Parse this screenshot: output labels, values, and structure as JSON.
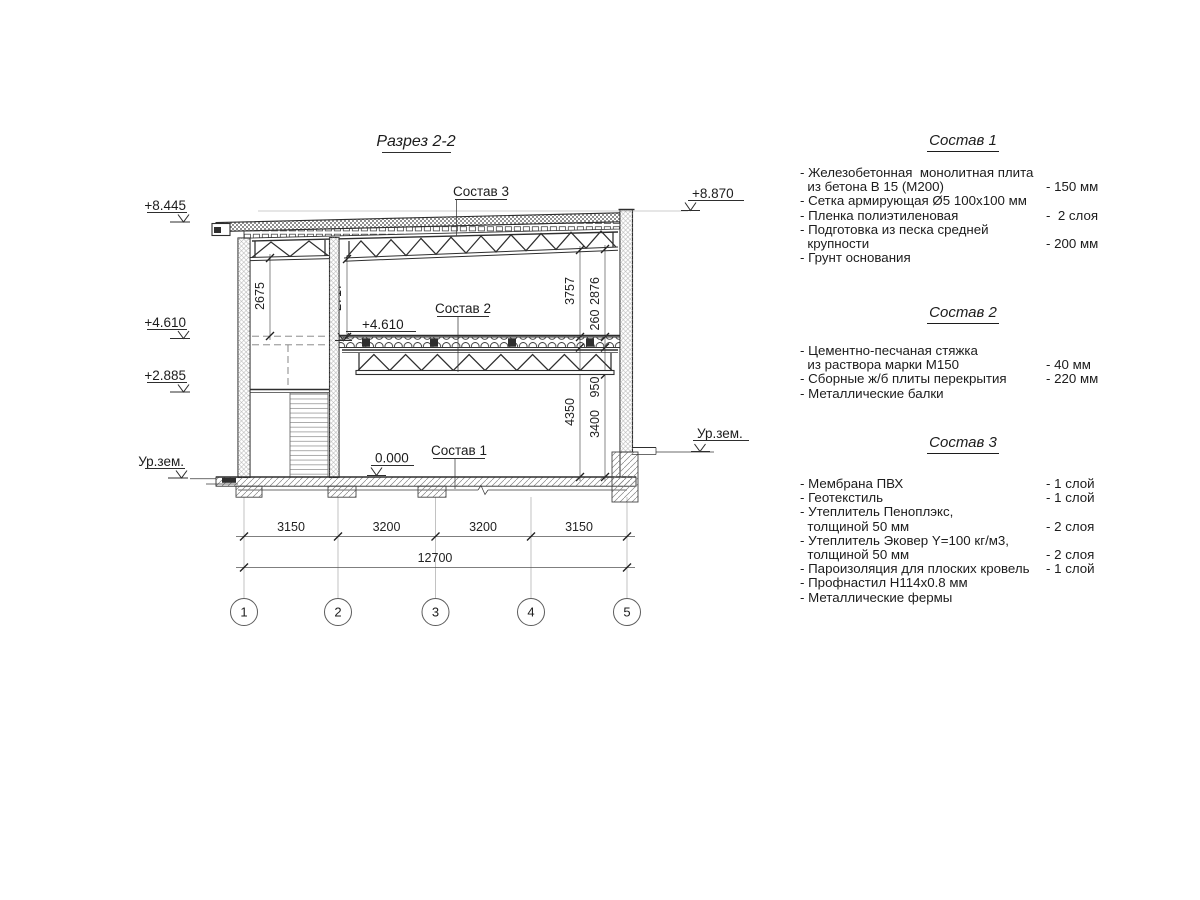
{
  "title": "Разрез 2-2",
  "drawing": {
    "elevations": {
      "roof_left": "+8.445",
      "roof_right": "+8.870",
      "mid_left": "+4.610",
      "mid_inner": "+4.610",
      "landing": "+2.885",
      "ground_left": "Ур.зем.",
      "ground_right": "Ур.зем.",
      "zero": "0.000"
    },
    "callouts": {
      "c1": "Состав 1",
      "c2": "Состав 2",
      "c3": "Состав 3"
    },
    "vdims": {
      "left_bay": "2675",
      "hall": "2717",
      "upper_right": "3757",
      "upper_clear": "2876",
      "slab": "260",
      "truss_depth": "950",
      "lower_clear": "3400",
      "lower_total": "4350"
    },
    "hdims": {
      "spans": [
        "3150",
        "3200",
        "3200",
        "3150"
      ],
      "total": "12700"
    },
    "axes": [
      "1",
      "2",
      "3",
      "4",
      "5"
    ]
  },
  "lists": [
    {
      "heading": "Состав 1",
      "items": [
        {
          "name": "- Железобетонная  монолитная плита\n  из бетона В 15 (М200)",
          "value": "- 150 мм"
        },
        {
          "name": "- Сетка армирующая Ø5 100х100 мм",
          "value": ""
        },
        {
          "name": "- Пленка полиэтиленовая",
          "value": "-  2 слоя"
        },
        {
          "name": "- Подготовка из песка средней\n  крупности",
          "value": "- 200 мм"
        },
        {
          "name": "- Грунт основания",
          "value": ""
        }
      ]
    },
    {
      "heading": "Состав 2",
      "items": [
        {
          "name": "- Цементно-песчаная стяжка\n  из раствора марки М150",
          "value": "- 40 мм"
        },
        {
          "name": "- Сборные ж/б плиты перекрытия",
          "value": "- 220 мм"
        },
        {
          "name": "- Металлические балки",
          "value": ""
        }
      ]
    },
    {
      "heading": "Состав 3",
      "items": [
        {
          "name": "- Мембрана ПВХ",
          "value": "- 1 слой"
        },
        {
          "name": "- Геотекстиль",
          "value": "- 1 слой"
        },
        {
          "name": "- Утеплитель Пеноплэкс,\n  толщиной 50 мм",
          "value": "- 2 слоя"
        },
        {
          "name": "- Утеплитель Эковер Y=100 кг/м3,\n  толщиной 50 мм",
          "value": "- 2 слоя"
        },
        {
          "name": "- Пароизоляция для плоских кровель",
          "value": "- 1 слой"
        },
        {
          "name": "- Профнастил Н114х0.8 мм",
          "value": ""
        },
        {
          "name": "- Металлические фермы",
          "value": ""
        }
      ]
    }
  ]
}
